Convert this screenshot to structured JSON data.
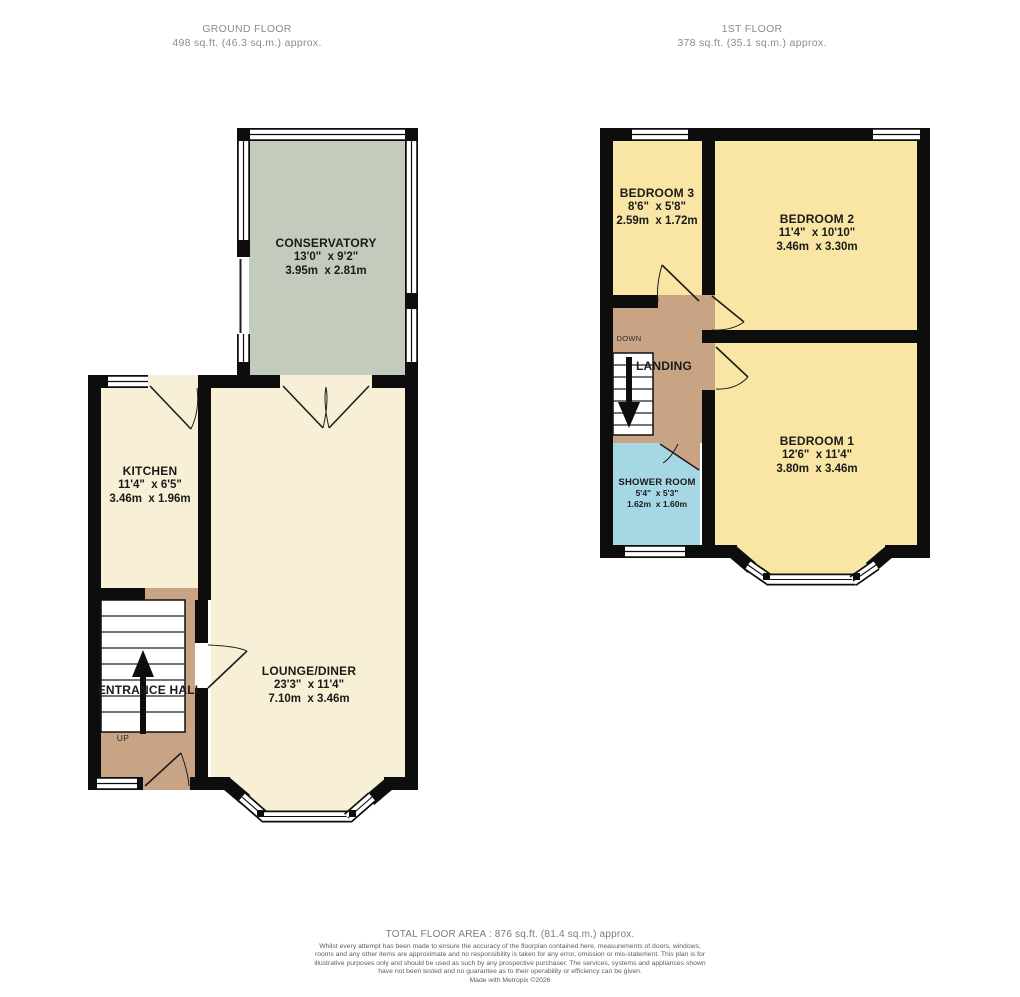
{
  "colors": {
    "wall": "#0d0d0d",
    "ground_room_fill": "#f7f0d7",
    "first_room_fill": "#f9e6a4",
    "conservatory_fill": "#c2cbbc",
    "hall_fill": "#c8a485",
    "shower_fill": "#a6d7e4",
    "window_fill": "#ffffff",
    "label_text": "#1a1a1a",
    "title_text": "#8c8c8c"
  },
  "ground_floor": {
    "title": "GROUND FLOOR",
    "subtitle": "498 sq.ft. (46.3 sq.m.) approx.",
    "rooms": {
      "conservatory": {
        "name": "CONSERVATORY",
        "dims_ft": "13'0\"  x 9'2\"",
        "dims_m": "3.95m  x 2.81m"
      },
      "kitchen": {
        "name": "KITCHEN",
        "dims_ft": "11'4\"  x 6'5\"",
        "dims_m": "3.46m  x 1.96m"
      },
      "lounge_diner": {
        "name": "LOUNGE/DINER",
        "dims_ft": "23'3\"  x 11'4\"",
        "dims_m": "7.10m  x 3.46m"
      },
      "entrance_hall": {
        "name": "ENTRANCE HALL"
      }
    },
    "stair_label": "UP"
  },
  "first_floor": {
    "title": "1ST FLOOR",
    "subtitle": "378 sq.ft. (35.1 sq.m.) approx.",
    "rooms": {
      "bedroom_3": {
        "name": "BEDROOM 3",
        "dims_ft": "8'6\"  x 5'8\"",
        "dims_m": "2.59m  x 1.72m"
      },
      "bedroom_2": {
        "name": "BEDROOM 2",
        "dims_ft": "11'4\"  x 10'10\"",
        "dims_m": "3.46m  x 3.30m"
      },
      "bedroom_1": {
        "name": "BEDROOM 1",
        "dims_ft": "12'6\"  x 11'4\"",
        "dims_m": "3.80m  x 3.46m"
      },
      "landing": {
        "name": "LANDING"
      },
      "shower_room": {
        "name": "SHOWER ROOM",
        "dims_ft": "5'4\"  x 5'3\"",
        "dims_m": "1.62m  x 1.60m"
      }
    },
    "stair_label": "DOWN"
  },
  "footer": {
    "total_area": "TOTAL FLOOR AREA : 876 sq.ft. (81.4 sq.m.) approx.",
    "disclaimer": "Whilst every attempt has been made to ensure the accuracy of the floorplan contained here, measurements of doors, windows, rooms and any other items are approximate and no responsibility is taken for any error, omission or mis-statement. This plan is for illustrative purposes only and should be used as such by any prospective purchaser. The services, systems and appliances shown have not been tested and no guarantee as to their operability or efficiency can be given.",
    "credit": "Made with Metropix ©2026"
  }
}
